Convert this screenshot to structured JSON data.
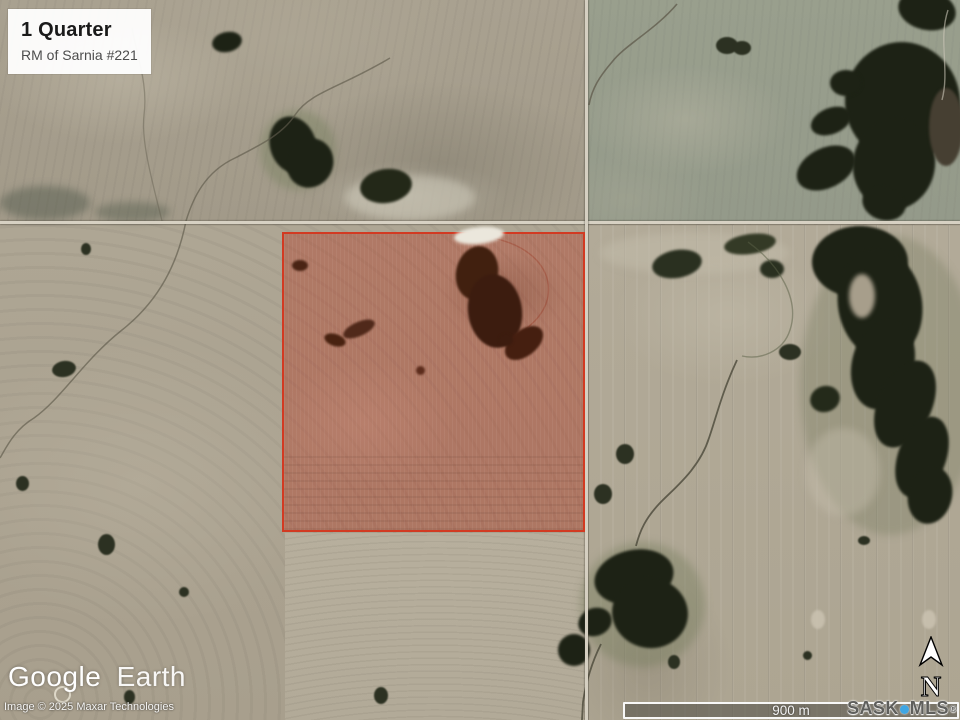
{
  "title_card": {
    "title": "1 Quarter",
    "subtitle": "RM of Sarnia #221"
  },
  "branding": {
    "google": "Google",
    "earth": "Earth"
  },
  "attribution": "Image © 2025 Maxar Technologies",
  "scale_bar": {
    "label": "900 m"
  },
  "compass": {
    "label": "N"
  },
  "mls_logo": {
    "prefix": "SASK",
    "suffix": "MLS",
    "registered": "®"
  },
  "colors": {
    "parcel_border": "#d23a22",
    "parcel_fill": "#b23c26",
    "mls_dot": "#3fa6e3"
  }
}
